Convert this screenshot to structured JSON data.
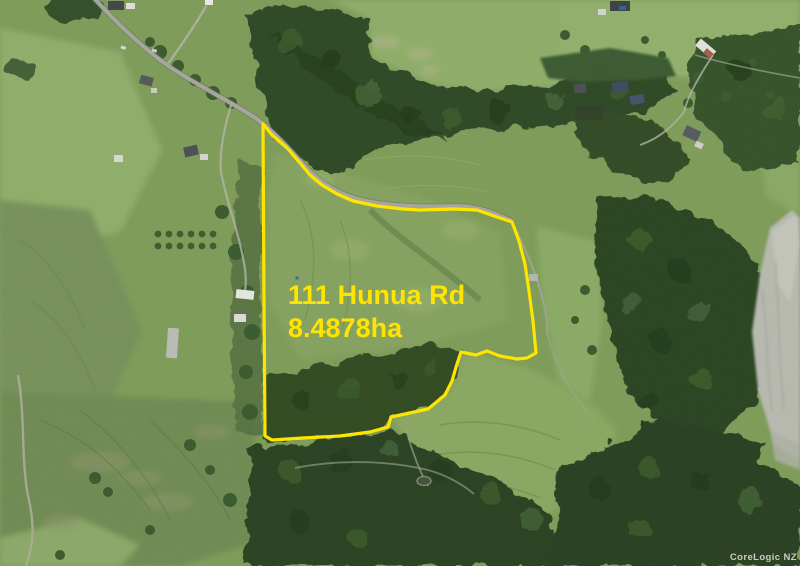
{
  "map": {
    "watermark": "CoreLogic NZ"
  },
  "property_overlay": {
    "address": "111 Hunua Rd",
    "area": "8.4878ha",
    "outline_color": "#FFE400"
  },
  "colors": {
    "annotation_yellow": "#FFE400",
    "pasture_green": "#7E9C59",
    "forest_green": "#2E4626",
    "road_grey": "#A6A79C",
    "quarry_grey": "#B8BAB0",
    "watermark_grey": "#E9EBE4"
  }
}
